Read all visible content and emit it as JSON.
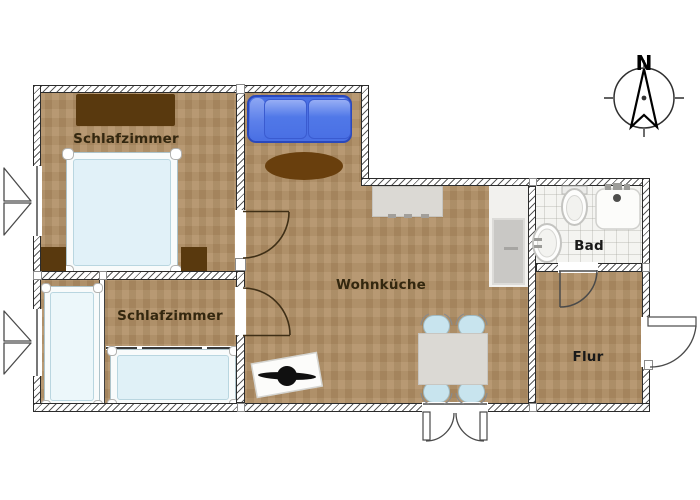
{
  "figure": {
    "type": "floor-plan",
    "description": "Apartment floor plan with two bedrooms, living kitchen, bathroom and hallway"
  },
  "labels": {
    "bedroom_top": "Schlafzimmer",
    "bedroom_bottom": "Schlafzimmer",
    "living_kitchen": "Wohnküche",
    "bathroom": "Bad",
    "hallway": "Flur",
    "compass_north": "N"
  },
  "colors": {
    "floor_wood": "#b19066",
    "bathroom_tile": "#f4f4f1",
    "wall_outline": "#2b2b2b",
    "sofa_blue": "#4a70e4",
    "rug_brown": "#693f0d",
    "furniture_dark_brown": "#59390e",
    "mattress_light_blue": "#e1f1f8",
    "chair_light_blue": "#c8e4ee"
  }
}
